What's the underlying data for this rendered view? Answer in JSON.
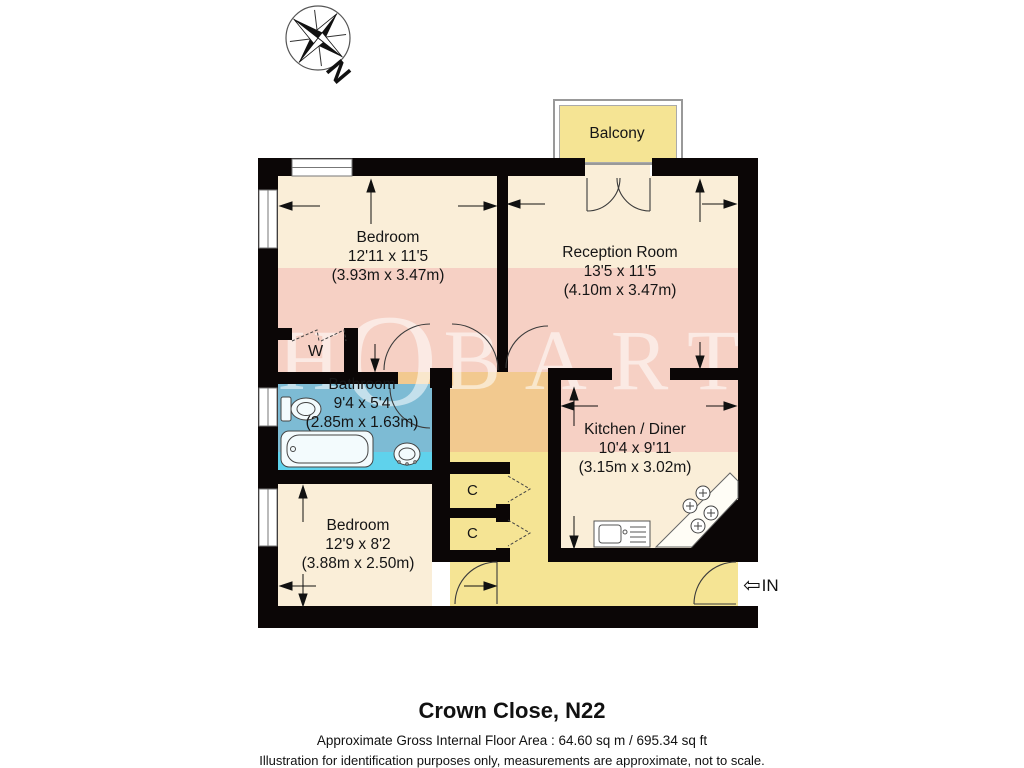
{
  "title_block": {
    "title": "Crown Close, N22",
    "area": "Approximate Gross Internal Floor Area : 64.60 sq m / 695.34 sq ft",
    "disclaimer": "Illustration for identification purposes only, measurements are approximate, not to scale."
  },
  "compass": {
    "label": "N"
  },
  "watermark": {
    "left": "H",
    "middle": "O",
    "right": "BARTS"
  },
  "entrance": {
    "arrow": "⇦",
    "label": "IN"
  },
  "rooms": {
    "balcony": {
      "name": "Balcony"
    },
    "bedroom1": {
      "name": "Bedroom",
      "dims_ft": "12'11 x 11'5",
      "dims_m": "(3.93m x 3.47m)"
    },
    "reception": {
      "name": "Reception Room",
      "dims_ft": "13'5 x 11'5",
      "dims_m": "(4.10m x 3.47m)"
    },
    "bathroom": {
      "name": "Bathroom",
      "dims_ft": "9'4 x 5'4",
      "dims_m": "(2.85m x 1.63m)"
    },
    "kitchen": {
      "name": "Kitchen / Diner",
      "dims_ft": "10'4 x 9'11",
      "dims_m": "(3.15m x 3.02m)"
    },
    "bedroom2": {
      "name": "Bedroom",
      "dims_ft": "12'9 x 8'2",
      "dims_m": "(3.88m x 2.50m)"
    },
    "wardrobe": {
      "label": "W"
    },
    "closet_top": {
      "label": "C"
    },
    "closet_bottom": {
      "label": "C"
    }
  },
  "colors": {
    "wall": "#0b0606",
    "floor_cream": "#faeed8",
    "accent_yellow": "#f5e494",
    "bathroom_cyan": "#5fd2ec",
    "watermark_pink": "rgba(231,106,128,0.22)",
    "watermark_text": "rgba(255,255,255,0.55)"
  }
}
